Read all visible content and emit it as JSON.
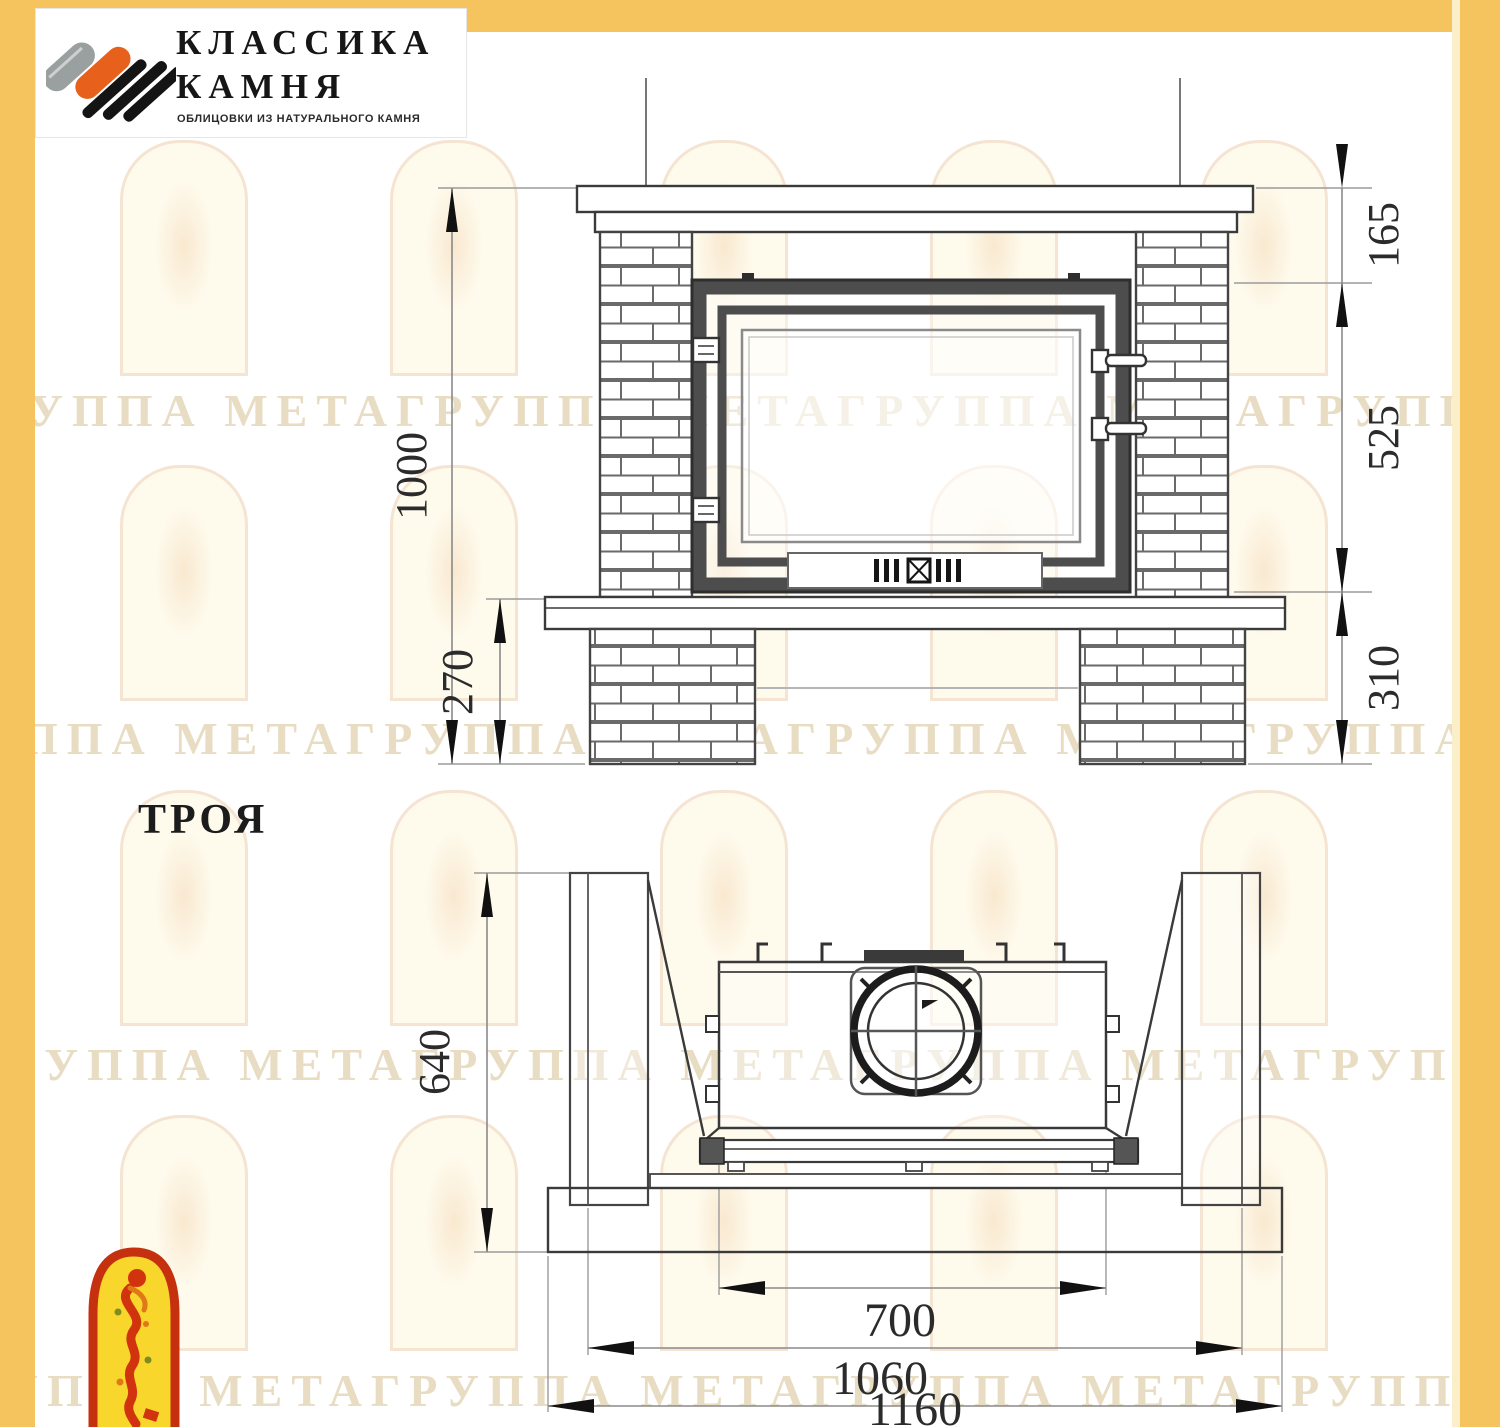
{
  "page": {
    "width": 1500,
    "height": 1427,
    "border_color": "#F5C45E",
    "background": "#FFFFFF"
  },
  "logo": {
    "title_line1": "КЛАССИКА",
    "title_line2": "КАМНЯ",
    "subtitle": "ОБЛИЦОВКИ ИЗ НАТУРАЛЬНОГО КАМНЯ",
    "colors": {
      "gray": "#9AA0A0",
      "orange": "#E8611C",
      "black": "#141414"
    }
  },
  "model": {
    "name": "ТРОЯ"
  },
  "front_view": {
    "dims": {
      "total_height": "1000",
      "pedestal_height": "270",
      "mantel_zone": "165",
      "firebox_height": "525",
      "base_zone": "310"
    }
  },
  "plan_view": {
    "dims": {
      "depth": "640",
      "firebox_width": "700",
      "body_width": "1060",
      "total_width": "1160"
    }
  },
  "watermark": {
    "row_text": "ГРУППА МЕТАГРУППА МЕТАГРУППА МЕТАГРУППА МЕТА",
    "tint": "rgba(214,192,146,0.55)"
  },
  "footer_logo": {
    "red": "#C5300E",
    "yellow": "#F8D62B"
  },
  "drawing": {
    "line_color": "#3A3A3A",
    "dim_color": "#8A8A8A",
    "arrow_color": "#111111",
    "text_color": "#2B2B2B"
  }
}
